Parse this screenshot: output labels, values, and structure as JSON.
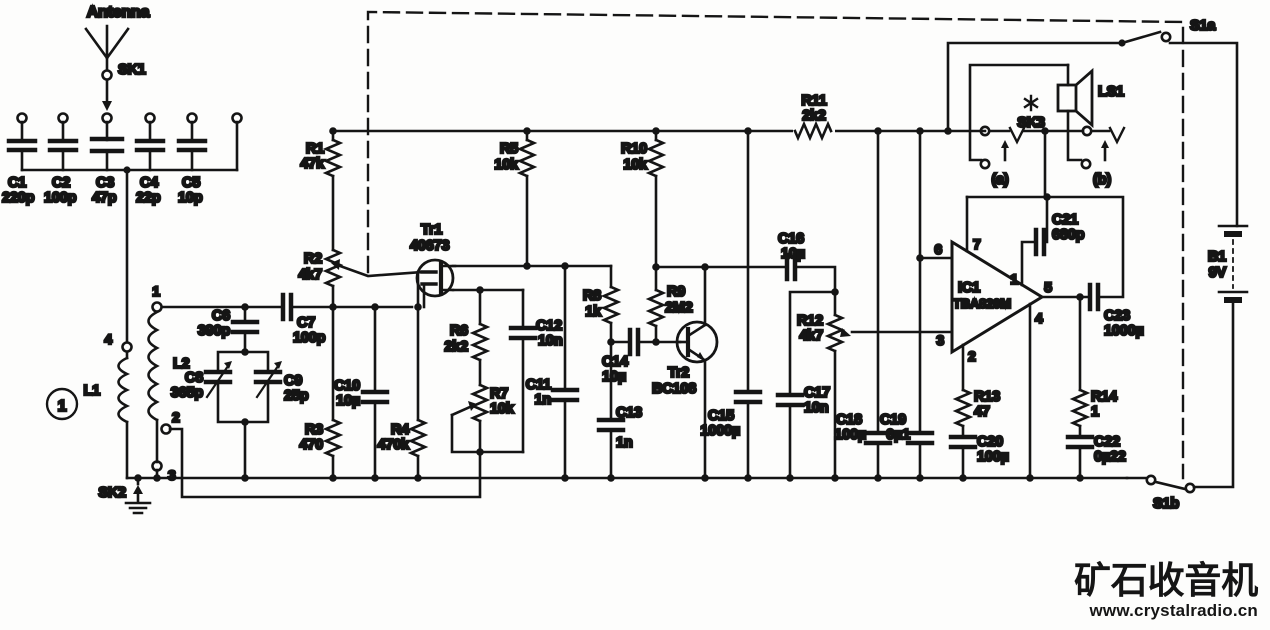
{
  "figure_label": "1",
  "labels": {
    "antenna": "Antenna",
    "sk1": "SK1",
    "sk2": "SK2",
    "sk3": "SK3",
    "s1a": "S1a",
    "s1b": "S1b",
    "ls1": "LS1",
    "jack_a": "(a)",
    "jack_b": "(b)"
  },
  "coil": {
    "l1": "L1",
    "l2": "L2",
    "t1": "1",
    "t2": "2",
    "t3": "3",
    "t4": "4"
  },
  "transistors": {
    "tr1": {
      "name": "Tr1",
      "part": "40673"
    },
    "tr2": {
      "name": "Tr2",
      "part": "BC108"
    }
  },
  "ic1": {
    "name": "IC1",
    "part": "TBA820M",
    "pin1": "1",
    "pin2": "2",
    "pin3": "3",
    "pin4": "4",
    "pin5": "5",
    "pin6": "6",
    "pin7": "7"
  },
  "battery": {
    "name": "B1",
    "value": "9V"
  },
  "parts": {
    "C1": {
      "name": "C1",
      "value": "220p"
    },
    "C2": {
      "name": "C2",
      "value": "100p"
    },
    "C3": {
      "name": "C3",
      "value": "47p"
    },
    "C4": {
      "name": "C4",
      "value": "22p"
    },
    "C5": {
      "name": "C5",
      "value": "10p"
    },
    "C6": {
      "name": "C6",
      "value": "390p"
    },
    "C7": {
      "name": "C7",
      "value": "100p"
    },
    "C8": {
      "name": "C8",
      "value": "365p"
    },
    "C9": {
      "name": "C9",
      "value": "25p"
    },
    "C10": {
      "name": "C10",
      "value": "10µ"
    },
    "C11": {
      "name": "C11",
      "value": "1n"
    },
    "C12": {
      "name": "C12",
      "value": "10n"
    },
    "C13": {
      "name": "C13",
      "value": "1n"
    },
    "C14": {
      "name": "C14",
      "value": "10µ"
    },
    "C15": {
      "name": "C15",
      "value": "1000µ"
    },
    "C16": {
      "name": "C16",
      "value": "10µ"
    },
    "C17": {
      "name": "C17",
      "value": "10n"
    },
    "C18": {
      "name": "C18",
      "value": "100µ"
    },
    "C19": {
      "name": "C19",
      "value": "0µ1"
    },
    "C20": {
      "name": "C20",
      "value": "100µ"
    },
    "C21": {
      "name": "C21",
      "value": "680p"
    },
    "C22": {
      "name": "C22",
      "value": "0µ22"
    },
    "C23": {
      "name": "C23",
      "value": "1000µ"
    },
    "R1": {
      "name": "R1",
      "value": "47k"
    },
    "R2": {
      "name": "R2",
      "value": "4k7"
    },
    "R3": {
      "name": "R3",
      "value": "470"
    },
    "R4": {
      "name": "R4",
      "value": "470k"
    },
    "R5": {
      "name": "R5",
      "value": "10k"
    },
    "R6": {
      "name": "R6",
      "value": "2k2"
    },
    "R7": {
      "name": "R7",
      "value": "10k"
    },
    "R8": {
      "name": "R8",
      "value": "1k"
    },
    "R9": {
      "name": "R9",
      "value": "2M2"
    },
    "R10": {
      "name": "R10",
      "value": "10k"
    },
    "R11": {
      "name": "R11",
      "value": "2k2"
    },
    "R12": {
      "name": "R12",
      "value": "4k7"
    },
    "R13": {
      "name": "R13",
      "value": "47"
    },
    "R14": {
      "name": "R14",
      "value": "1"
    }
  },
  "watermark": {
    "title": "矿石收音机",
    "url": "www.crystalradio.cn",
    "color": "#1c3b6f"
  }
}
